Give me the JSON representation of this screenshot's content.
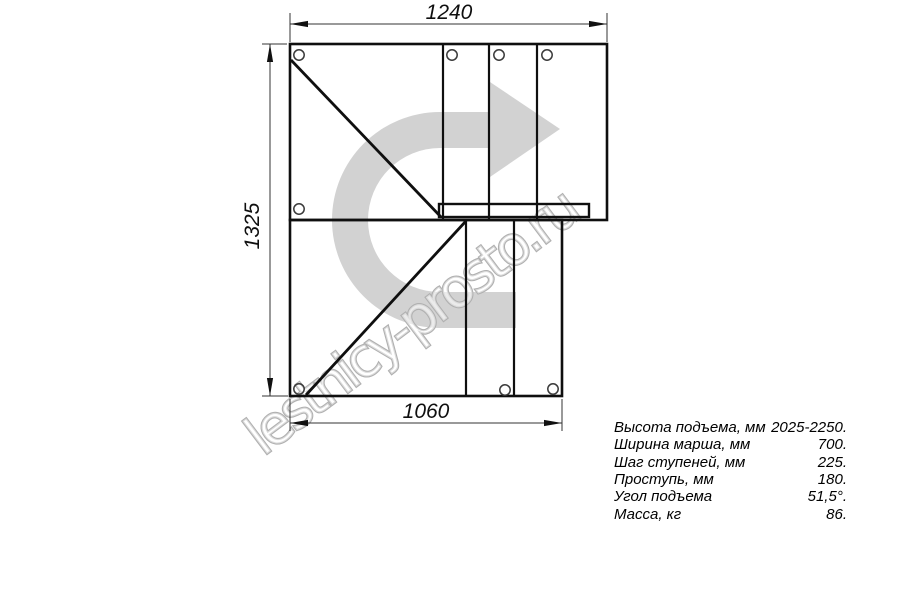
{
  "drawing": {
    "title": "stair-plan-top-view",
    "watermark": "lestnicy-prosto.ru",
    "dimensions": {
      "top_width_mm": "1240",
      "left_height_mm": "1325",
      "bottom_width_mm": "1060"
    },
    "colors": {
      "line": "#0f0f0f",
      "dim_line": "#333333",
      "arrow_fill": "#d2d2d2",
      "watermark_stroke": "#b0b0b0",
      "background": "#ffffff"
    }
  },
  "specs": {
    "rows": [
      {
        "label": "Высота подъема, мм",
        "value": "2025-2250."
      },
      {
        "label": "Ширина марша, мм",
        "value": "700."
      },
      {
        "label": "Шаг ступеней, мм",
        "value": "225."
      },
      {
        "label": "Проступь, мм",
        "value": "180."
      },
      {
        "label": "Угол подъема",
        "value": "51,5°."
      },
      {
        "label": "Масса, кг",
        "value": "86."
      }
    ]
  }
}
